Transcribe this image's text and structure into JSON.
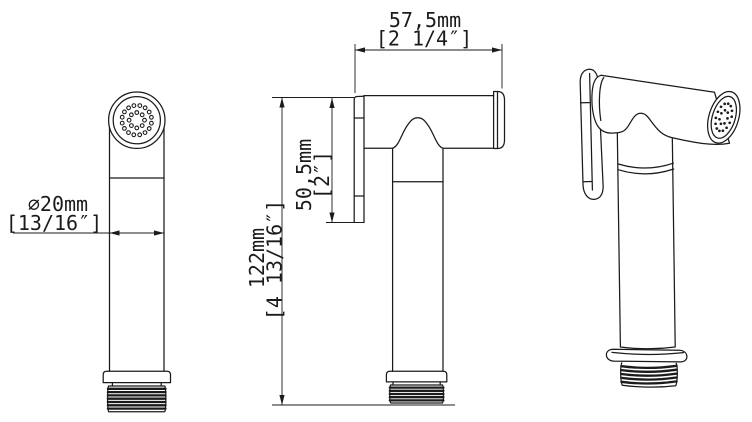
{
  "drawing": {
    "background": "#ffffff",
    "line_color": "#1b1b1b",
    "dimensions": {
      "head_width": {
        "mm": "57,5mm",
        "inch": "[2 1/4″]"
      },
      "head_height": {
        "mm": "50,5mm",
        "inch": "[2″]"
      },
      "total_height": {
        "mm": "122mm",
        "inch": "[4 13/16″]"
      },
      "handle_diameter": {
        "mm": "⌀20mm",
        "inch": "[13/16″]"
      }
    }
  }
}
